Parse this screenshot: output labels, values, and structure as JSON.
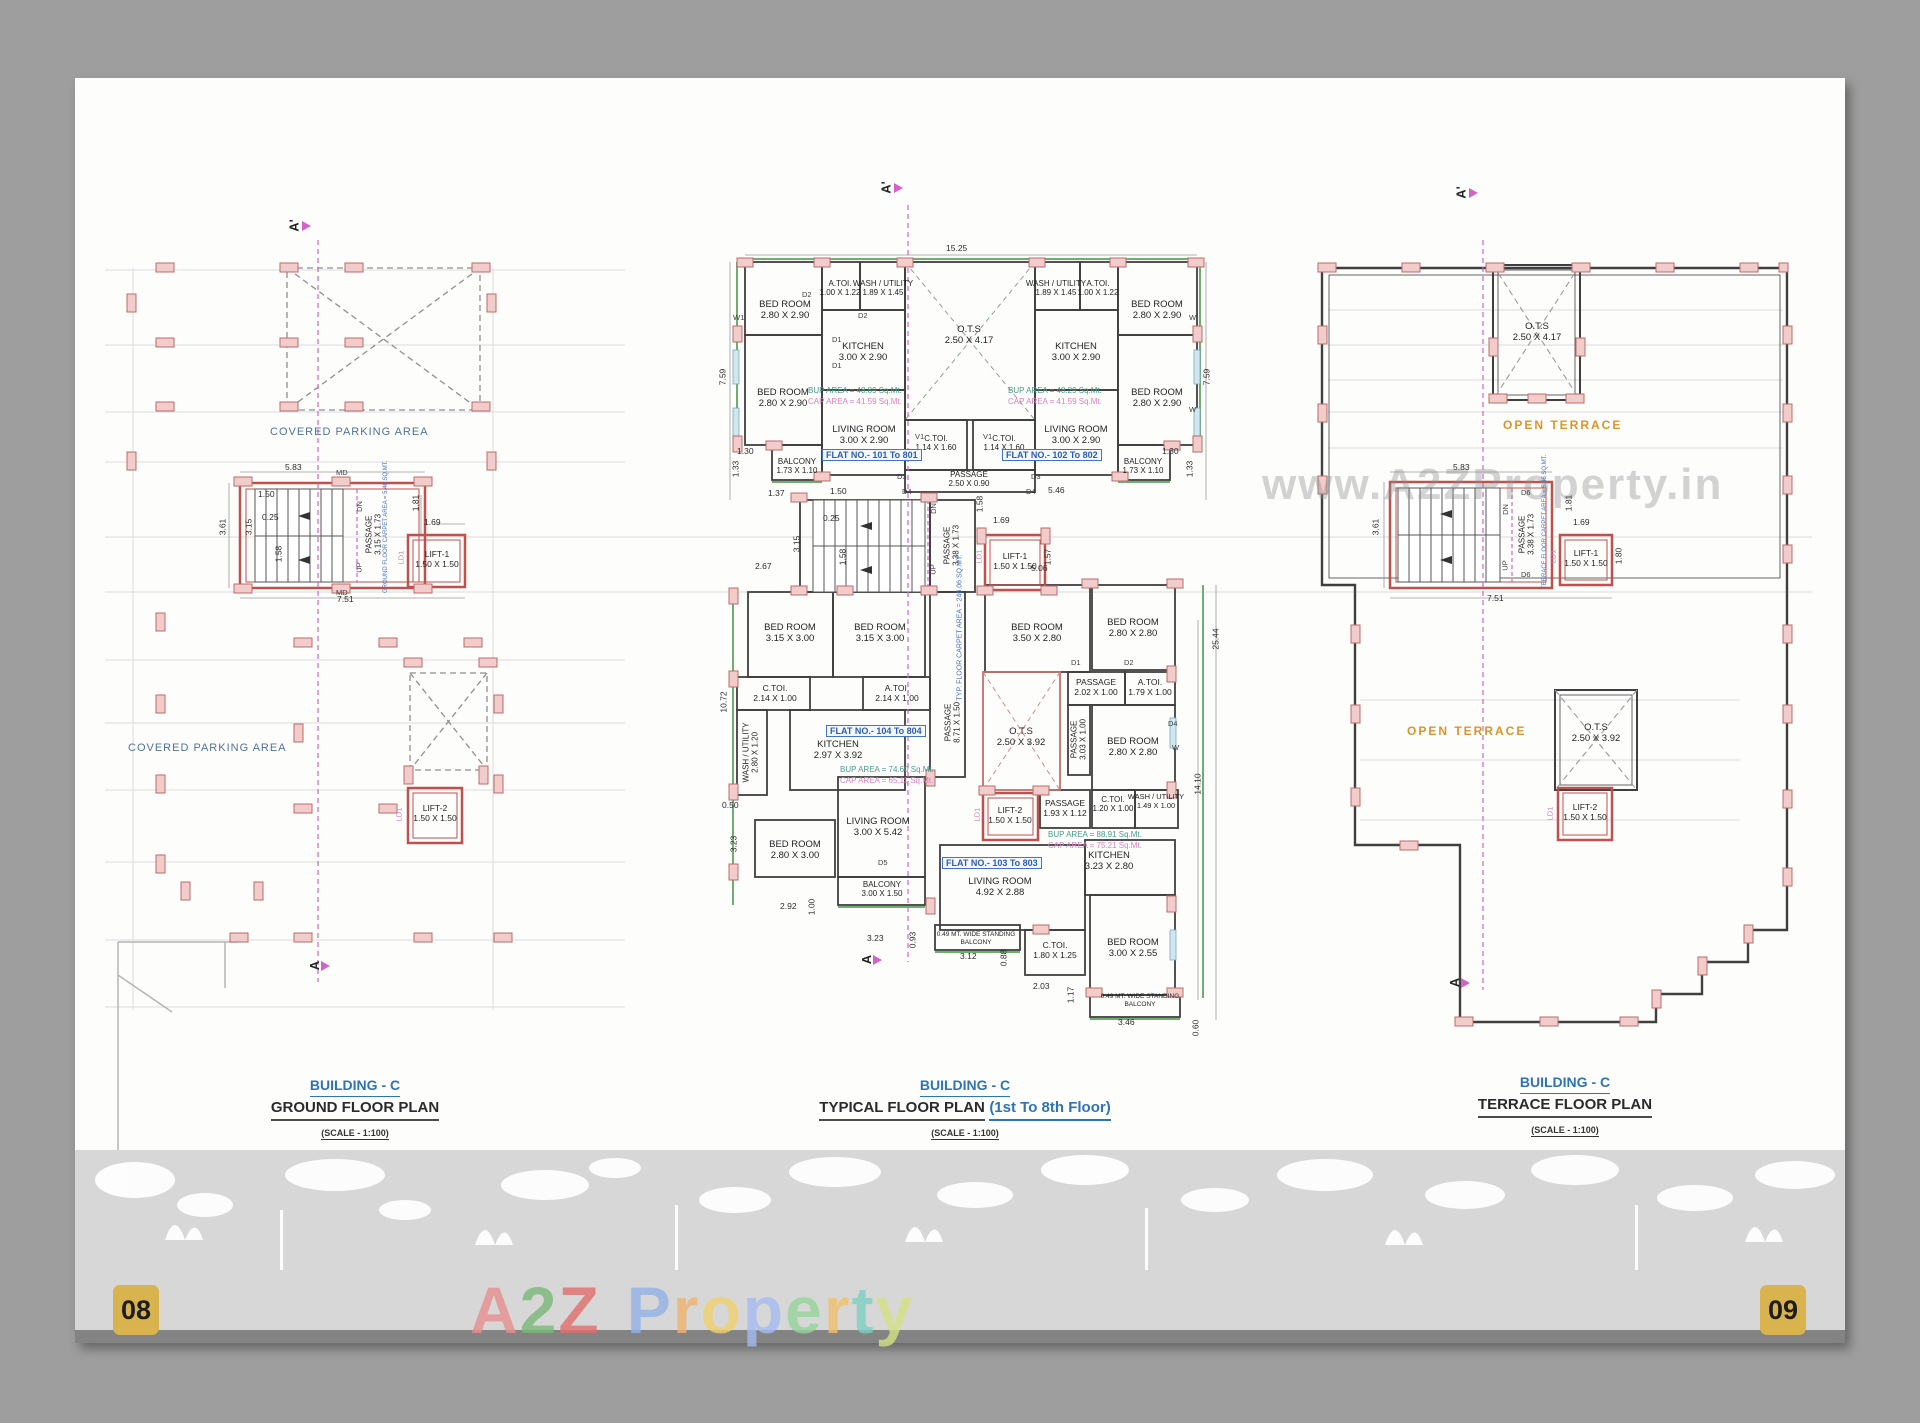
{
  "page": {
    "page_left": "08",
    "page_right": "09",
    "watermark_url": "www.A2ZProperty.in",
    "brand": [
      "A",
      "2",
      "Z",
      "P",
      "r",
      "o",
      "p",
      "e",
      "r",
      "t",
      "y"
    ]
  },
  "tags": {
    "d1": "D1",
    "d2": "D2",
    "d3": "D3",
    "d4": "D4",
    "d5": "D5",
    "d6": "D6",
    "w1": "W1",
    "w": "W",
    "v1": "V1",
    "md": "MD",
    "ld1": "LD1",
    "dn": "DN",
    "up": "UP",
    "sec_top": "A'",
    "sec_bot": "A"
  },
  "titles": {
    "ground": {
      "building": "BUILDING - C",
      "plan": "GROUND FLOOR PLAN",
      "scale": "(SCALE - 1:100)"
    },
    "typical": {
      "building": "BUILDING - C",
      "plan": "TYPICAL FLOOR PLAN",
      "floors": "(1st To 8th Floor)",
      "scale": "(SCALE - 1:100)"
    },
    "terrace": {
      "building": "BUILDING - C",
      "plan": "TERRACE FLOOR PLAN",
      "scale": "(SCALE - 1:100)"
    }
  },
  "ground": {
    "parking_top": "COVERED PARKING AREA",
    "parking_bottom": "COVERED PARKING AREA",
    "passage": {
      "n": "PASSAGE",
      "s": "3.15 X 1.73"
    },
    "carpet": "GROUND FLOOR CARPET AREA = 5.46 SQ.MT.",
    "lift1": {
      "n": "LIFT-1",
      "s": "1.50 X 1.50"
    },
    "lift2": {
      "n": "LIFT-2",
      "s": "1.50 X 1.50"
    },
    "dims": [
      "5.83",
      "7.51",
      "3.61",
      "1.50",
      "0.25",
      "1.58",
      "3.15",
      "1.81",
      "1.69"
    ]
  },
  "typical": {
    "rooms": [
      {
        "n": "BED ROOM",
        "s": "2.80 X 2.90"
      },
      {
        "n": "A.TOI.",
        "s": "1.00 X 1.22"
      },
      {
        "n": "WASH / UTILITY",
        "s": "1.89 X 1.45"
      },
      {
        "n": "KITCHEN",
        "s": "3.00 X 2.90"
      },
      {
        "n": "BED ROOM",
        "s": "2.80 X 2.90"
      },
      {
        "n": "LIVING ROOM",
        "s": "3.00 X 2.90"
      },
      {
        "n": "BALCONY",
        "s": "1.73 X 1.10"
      },
      {
        "n": "O.T.S",
        "s": "2.50 X 4.17"
      },
      {
        "n": "C.TOI.",
        "s": "1.14 X 1.60"
      },
      {
        "n": "C.TOI.",
        "s": "1.14 X 1.60"
      },
      {
        "n": "PASSAGE",
        "s": "2.50 X 0.90"
      },
      {
        "n": "WASH / UTILITY",
        "s": "1.89 X 1.45"
      },
      {
        "n": "A.TOI.",
        "s": "1.00 X 1.22"
      },
      {
        "n": "BED ROOM",
        "s": "2.80 X 2.90"
      },
      {
        "n": "KITCHEN",
        "s": "3.00 X 2.90"
      },
      {
        "n": "BED ROOM",
        "s": "2.80 X 2.90"
      },
      {
        "n": "LIVING ROOM",
        "s": "3.00 X 2.90"
      },
      {
        "n": "BALCONY",
        "s": "1.73 X 1.10"
      },
      {
        "n": "PASSAGE",
        "s": "3.38 X 1.73"
      },
      {
        "n": "LIFT-1",
        "s": "1.50 X 1.50"
      },
      {
        "n": "BED ROOM",
        "s": "3.15 X 3.00"
      },
      {
        "n": "BED ROOM",
        "s": "3.15 X 3.00"
      },
      {
        "n": "C.TOI.",
        "s": "2.14 X 1.00"
      },
      {
        "n": "A.TOI.",
        "s": "2.14 X 1.00"
      },
      {
        "n": "WASH / UTILITY",
        "s": "2.80 X 1.20"
      },
      {
        "n": "KITCHEN",
        "s": "2.97 X 3.92"
      },
      {
        "n": "LIVING ROOM",
        "s": "3.00 X 5.42"
      },
      {
        "n": "BED ROOM",
        "s": "2.80 X 3.00"
      },
      {
        "n": "BALCONY",
        "s": "3.00 X 1.50"
      },
      {
        "n": "PASSAGE",
        "s": "8.71 X 1.50"
      },
      {
        "n": "BED ROOM",
        "s": "3.50 X 2.80"
      },
      {
        "n": "BED ROOM",
        "s": "2.80 X 2.80"
      },
      {
        "n": "PASSAGE",
        "s": "2.02 X 1.00"
      },
      {
        "n": "A.TOI.",
        "s": "1.79 X 1.00"
      },
      {
        "n": "O.T.S",
        "s": "2.50 X 3.92"
      },
      {
        "n": "PASSAGE",
        "s": "3.03 X 1.00"
      },
      {
        "n": "BED ROOM",
        "s": "2.80 X 2.80"
      },
      {
        "n": "LIFT-2",
        "s": "1.50 X 1.50"
      },
      {
        "n": "PASSAGE",
        "s": "1.93 X 1.12"
      },
      {
        "n": "C.TOI.",
        "s": "1.20 X 1.00"
      },
      {
        "n": "WASH / UTILITY",
        "s": "1.49 X 1.00"
      },
      {
        "n": "KITCHEN",
        "s": "3.23 X 2.80"
      },
      {
        "n": "LIVING ROOM",
        "s": "4.92 X 2.88"
      },
      {
        "n": "C.TOI.",
        "s": "1.80 X 1.25"
      },
      {
        "n": "BED ROOM",
        "s": "3.00 X 2.55"
      }
    ],
    "flats": {
      "f101": "FLAT NO.- 101 To 801",
      "f102": "FLAT NO.- 102 To 802",
      "f103": "FLAT NO.- 103 To 803",
      "f104": "FLAT NO.- 104 To 804"
    },
    "areas": {
      "bup101": "BUP AREA = 48.89 Sq.Mt.",
      "cap101": "CAP AREA = 41.59 Sq.Mt.",
      "bup102": "BUP AREA = 48.29 Sq.Mt.",
      "cap102": "CAP AREA = 41.59 Sq.Mt.",
      "bup103": "BUP AREA = 88.91 Sq.Mt.",
      "cap103": "CAP AREA = 75.21 Sq.Mt.",
      "bup104": "BUP AREA = 74.60 Sq.Mt.",
      "cap104": "CAP AREA = 65.11 Sq.Mt."
    },
    "carpet": "TYP. FLOOR CARPET AREA = 246.06 SQ.MT.",
    "balcony_note": "0.49 MT. WIDE STANDING BALCONY",
    "dims": [
      "15.25",
      "7.59",
      "7.59",
      "1.30",
      "1.33",
      "1.30",
      "1.33",
      "1.37",
      "1.50",
      "0.25",
      "3.15",
      "1.58",
      "2.67",
      "5.46",
      "1.58",
      "1.69",
      "1.57",
      "5.06",
      "10.72",
      "0.50",
      "3.23",
      "2.92",
      "1.00",
      "3.23",
      "0.93",
      "3.12",
      "0.88",
      "2.03",
      "1.17",
      "3.46",
      "0.60",
      "25.44",
      "14.10"
    ]
  },
  "terrace": {
    "open1": "OPEN TERRACE",
    "open2": "OPEN TERRACE",
    "ots1": {
      "n": "O.T.S",
      "s": "2.50 X 4.17"
    },
    "ots2": {
      "n": "O.T.S",
      "s": "2.50 X 3.92"
    },
    "passage": {
      "n": "PASSAGE",
      "s": "3.38 X 1.73"
    },
    "carpet": "TERRACE FLOOR CARPET AREA = 5.46 SQ.MT.",
    "lift1": {
      "n": "LIFT-1",
      "s": "1.50 X 1.50"
    },
    "lift2": {
      "n": "LIFT-2",
      "s": "1.50 X 1.50"
    },
    "dims": [
      "5.83",
      "7.51",
      "3.61",
      "1.81",
      "1.69",
      "1.80"
    ]
  }
}
